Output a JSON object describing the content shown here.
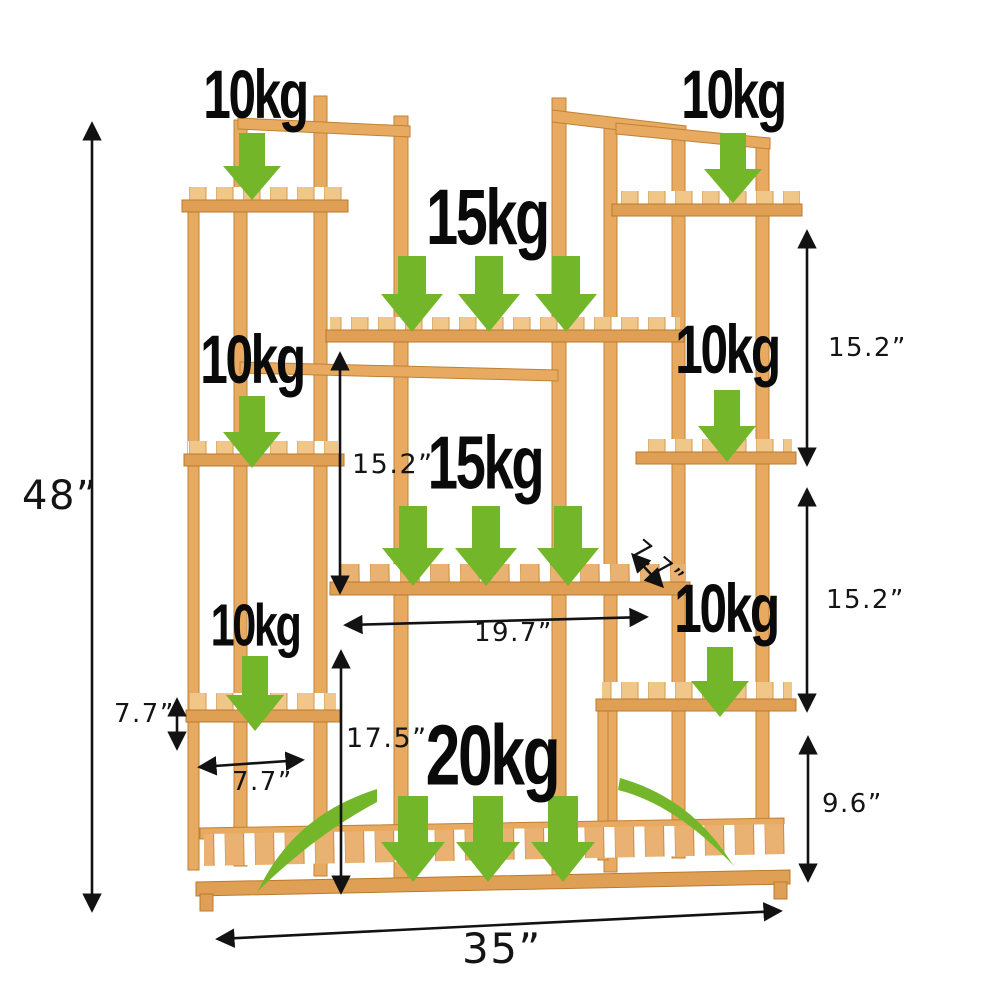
{
  "diagram": {
    "title": "bamboo plant stand load and dimension diagram",
    "colors": {
      "wood": "#e7aa60",
      "wood_light": "#f1c689",
      "wood_rail": "#dfa055",
      "wood_dark": "#c98c3f",
      "arrow_green": "#74b629",
      "annotation_black": "#121212",
      "background": "#ffffff"
    },
    "weights": [
      {
        "position": "top-left",
        "text": "10kg"
      },
      {
        "position": "top-right",
        "text": "10kg"
      },
      {
        "position": "upper-center",
        "text": "15kg"
      },
      {
        "position": "middle-left",
        "text": "10kg"
      },
      {
        "position": "middle-right",
        "text": "10kg"
      },
      {
        "position": "center",
        "text": "15kg"
      },
      {
        "position": "lower-left",
        "text": "10kg"
      },
      {
        "position": "lower-right",
        "text": "10kg"
      },
      {
        "position": "bottom-center",
        "text": "20kg"
      }
    ],
    "dimensions": [
      {
        "name": "overall-height",
        "text": "48”"
      },
      {
        "name": "overall-width",
        "text": "35”"
      },
      {
        "name": "right-upper-tier-height",
        "text": "15.2”"
      },
      {
        "name": "right-lower-tier-height",
        "text": "15.2”"
      },
      {
        "name": "right-bottom-tier-height",
        "text": "9.6”"
      },
      {
        "name": "center-tier-height",
        "text": "15.2”"
      },
      {
        "name": "center-bottom-tier-height",
        "text": "17.5”"
      },
      {
        "name": "middle-shelf-length",
        "text": "19.7”"
      },
      {
        "name": "middle-shelf-depth",
        "text": "7.7”"
      },
      {
        "name": "small-shelf-height",
        "text": "7.7”"
      },
      {
        "name": "small-shelf-width",
        "text": "7.7”"
      }
    ]
  }
}
